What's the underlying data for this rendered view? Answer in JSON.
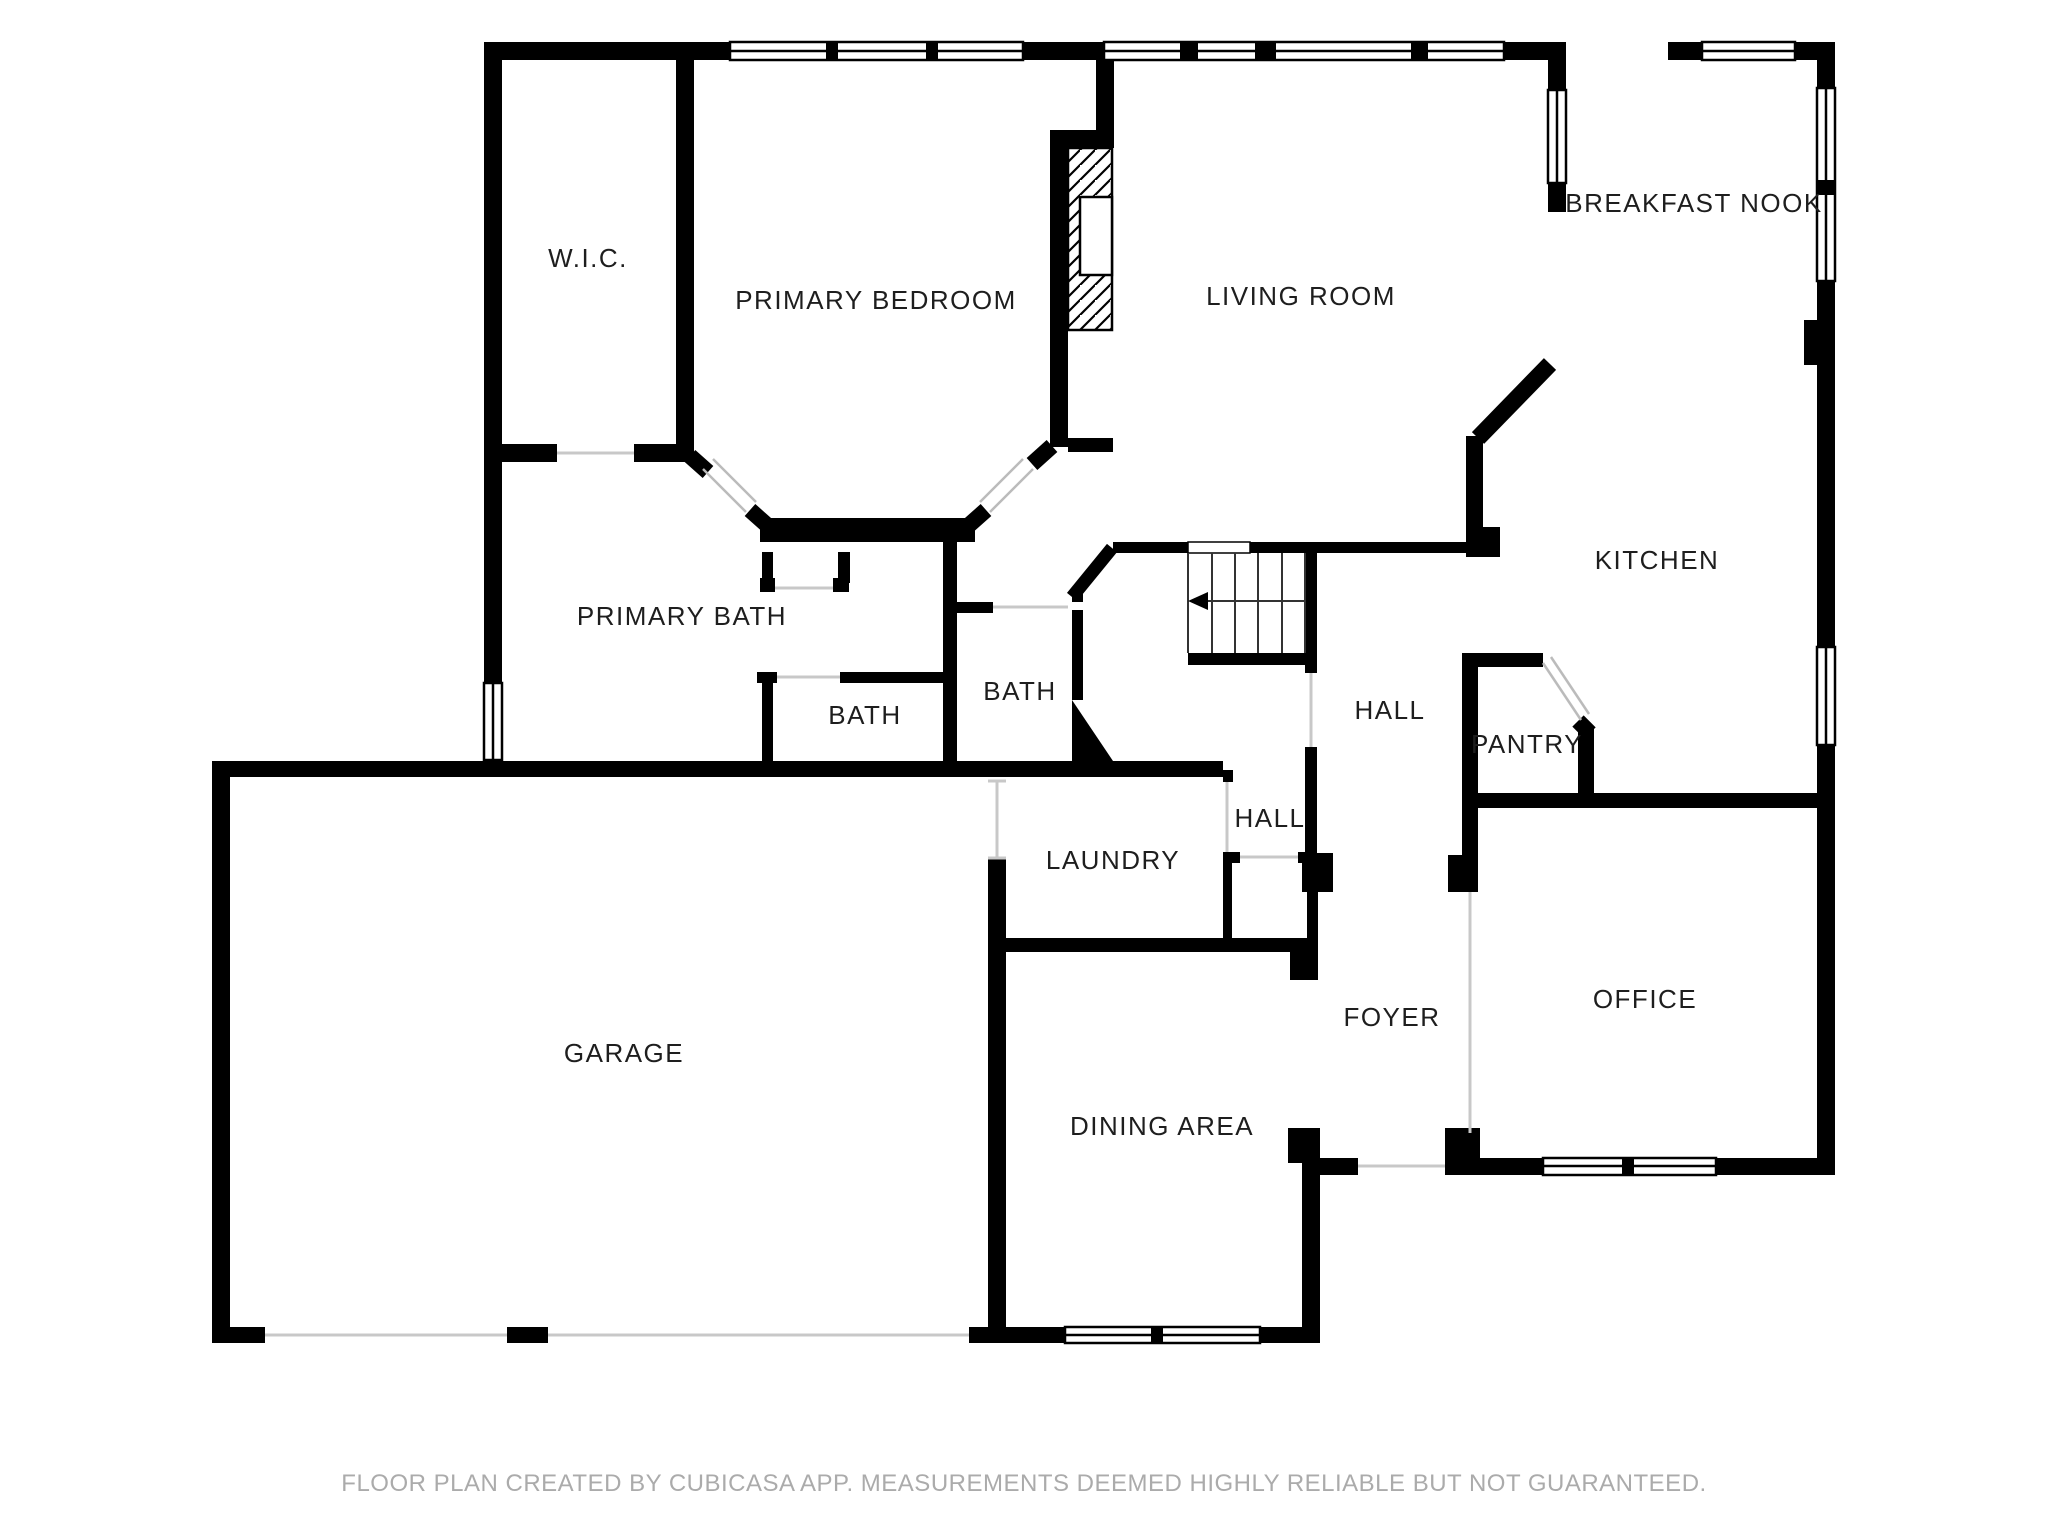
{
  "meta": {
    "type": "floor-plan",
    "creator_note": "FLOOR PLAN CREATED BY CUBICASA APP. MEASUREMENTS DEEMED HIGHLY RELIABLE BUT NOT GUARANTEED."
  },
  "colors": {
    "wall": "#000000",
    "floor": "#ffffff",
    "label": "#1e1e1e",
    "door_line": "#c8c8c8",
    "footer": "#ABABAB"
  },
  "footer": {
    "text": "FLOOR PLAN CREATED BY CUBICASA APP. MEASUREMENTS DEEMED HIGHLY RELIABLE BUT NOT GUARANTEED."
  },
  "rooms": [
    {
      "id": "wic",
      "label": "W.I.C.",
      "x": 588,
      "y": 260,
      "size": 26
    },
    {
      "id": "primary-bedroom",
      "label": "PRIMARY BEDROOM",
      "x": 876,
      "y": 302,
      "size": 26
    },
    {
      "id": "living-room",
      "label": "LIVING ROOM",
      "x": 1301,
      "y": 298,
      "size": 26
    },
    {
      "id": "breakfast-nook",
      "label": "BREAKFAST NOOK",
      "x": 1694,
      "y": 205,
      "size": 26
    },
    {
      "id": "kitchen",
      "label": "KITCHEN",
      "x": 1657,
      "y": 562,
      "size": 26
    },
    {
      "id": "primary-bath",
      "label": "PRIMARY BATH",
      "x": 682,
      "y": 618,
      "size": 26
    },
    {
      "id": "bath-left",
      "label": "BATH",
      "x": 865,
      "y": 717,
      "size": 26
    },
    {
      "id": "bath-right",
      "label": "BATH",
      "x": 1020,
      "y": 693,
      "size": 26
    },
    {
      "id": "hall-main",
      "label": "HALL",
      "x": 1390,
      "y": 712,
      "size": 26
    },
    {
      "id": "pantry",
      "label": "PANTRY",
      "x": 1527,
      "y": 746,
      "size": 26
    },
    {
      "id": "hall-small",
      "label": "HALL",
      "x": 1270,
      "y": 820,
      "size": 26
    },
    {
      "id": "laundry",
      "label": "LAUNDRY",
      "x": 1113,
      "y": 862,
      "size": 26
    },
    {
      "id": "foyer",
      "label": "FOYER",
      "x": 1392,
      "y": 1019,
      "size": 26
    },
    {
      "id": "office",
      "label": "OFFICE",
      "x": 1645,
      "y": 1001,
      "size": 26
    },
    {
      "id": "garage",
      "label": "GARAGE",
      "x": 624,
      "y": 1055,
      "size": 26
    },
    {
      "id": "dining-area",
      "label": "DINING AREA",
      "x": 1162,
      "y": 1128,
      "size": 26
    }
  ]
}
